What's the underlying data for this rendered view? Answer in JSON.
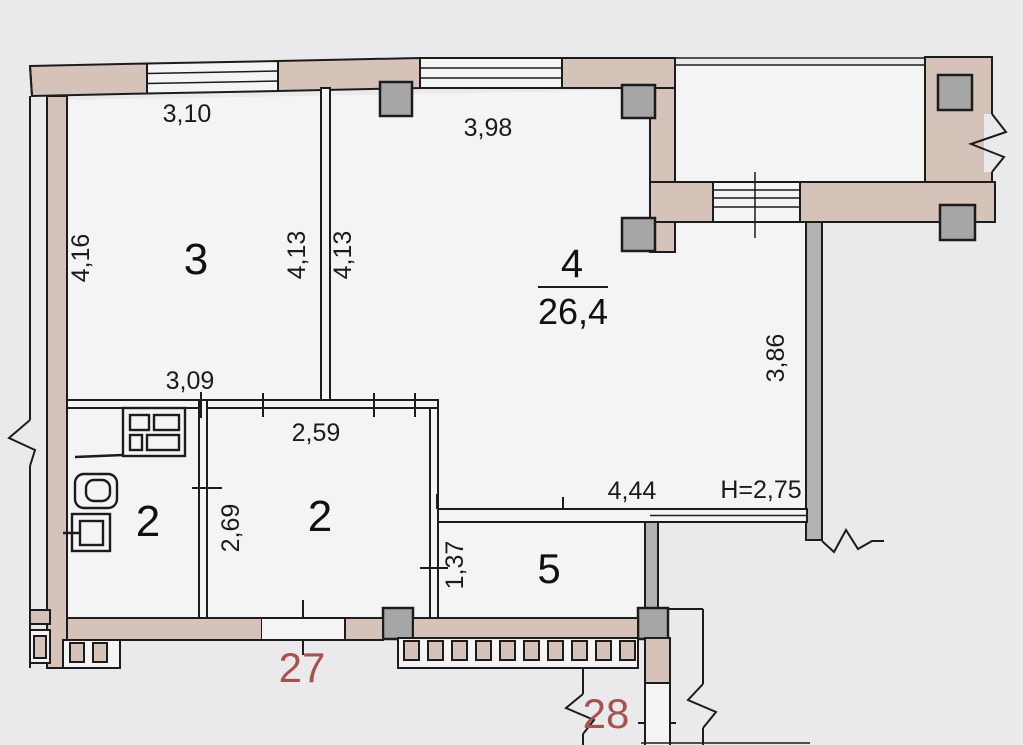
{
  "drawing": {
    "kind": "apartment floor plan"
  },
  "colors": {
    "wall_fill": "#d5c2b9",
    "column_fill": "#a6a6a6",
    "gray_wall_fill": "#b2b2b2",
    "line_color": "#1c1c1c",
    "unit_red": "#a8514e",
    "page_bg": "#eaeaec",
    "room_bg": "#f4f4f4"
  },
  "rooms": {
    "room3": {
      "number": "3",
      "width": "3,10",
      "height": "4,16",
      "wall_dim": "4,13"
    },
    "room4": {
      "number": "4",
      "area": "26,4",
      "width": "3,98",
      "wall_dim": "4,13"
    },
    "bathroom": {
      "number": "2",
      "width": "3,09"
    },
    "hall": {
      "number": "2",
      "width": "2,59",
      "height": "2,69"
    },
    "room5": {
      "number": "5",
      "height": "1,37"
    },
    "corridor": {
      "width": "4,44",
      "ceiling_height": "H=2,75",
      "wall_height": "3,86"
    }
  },
  "units": {
    "left": "27",
    "right": "28"
  }
}
